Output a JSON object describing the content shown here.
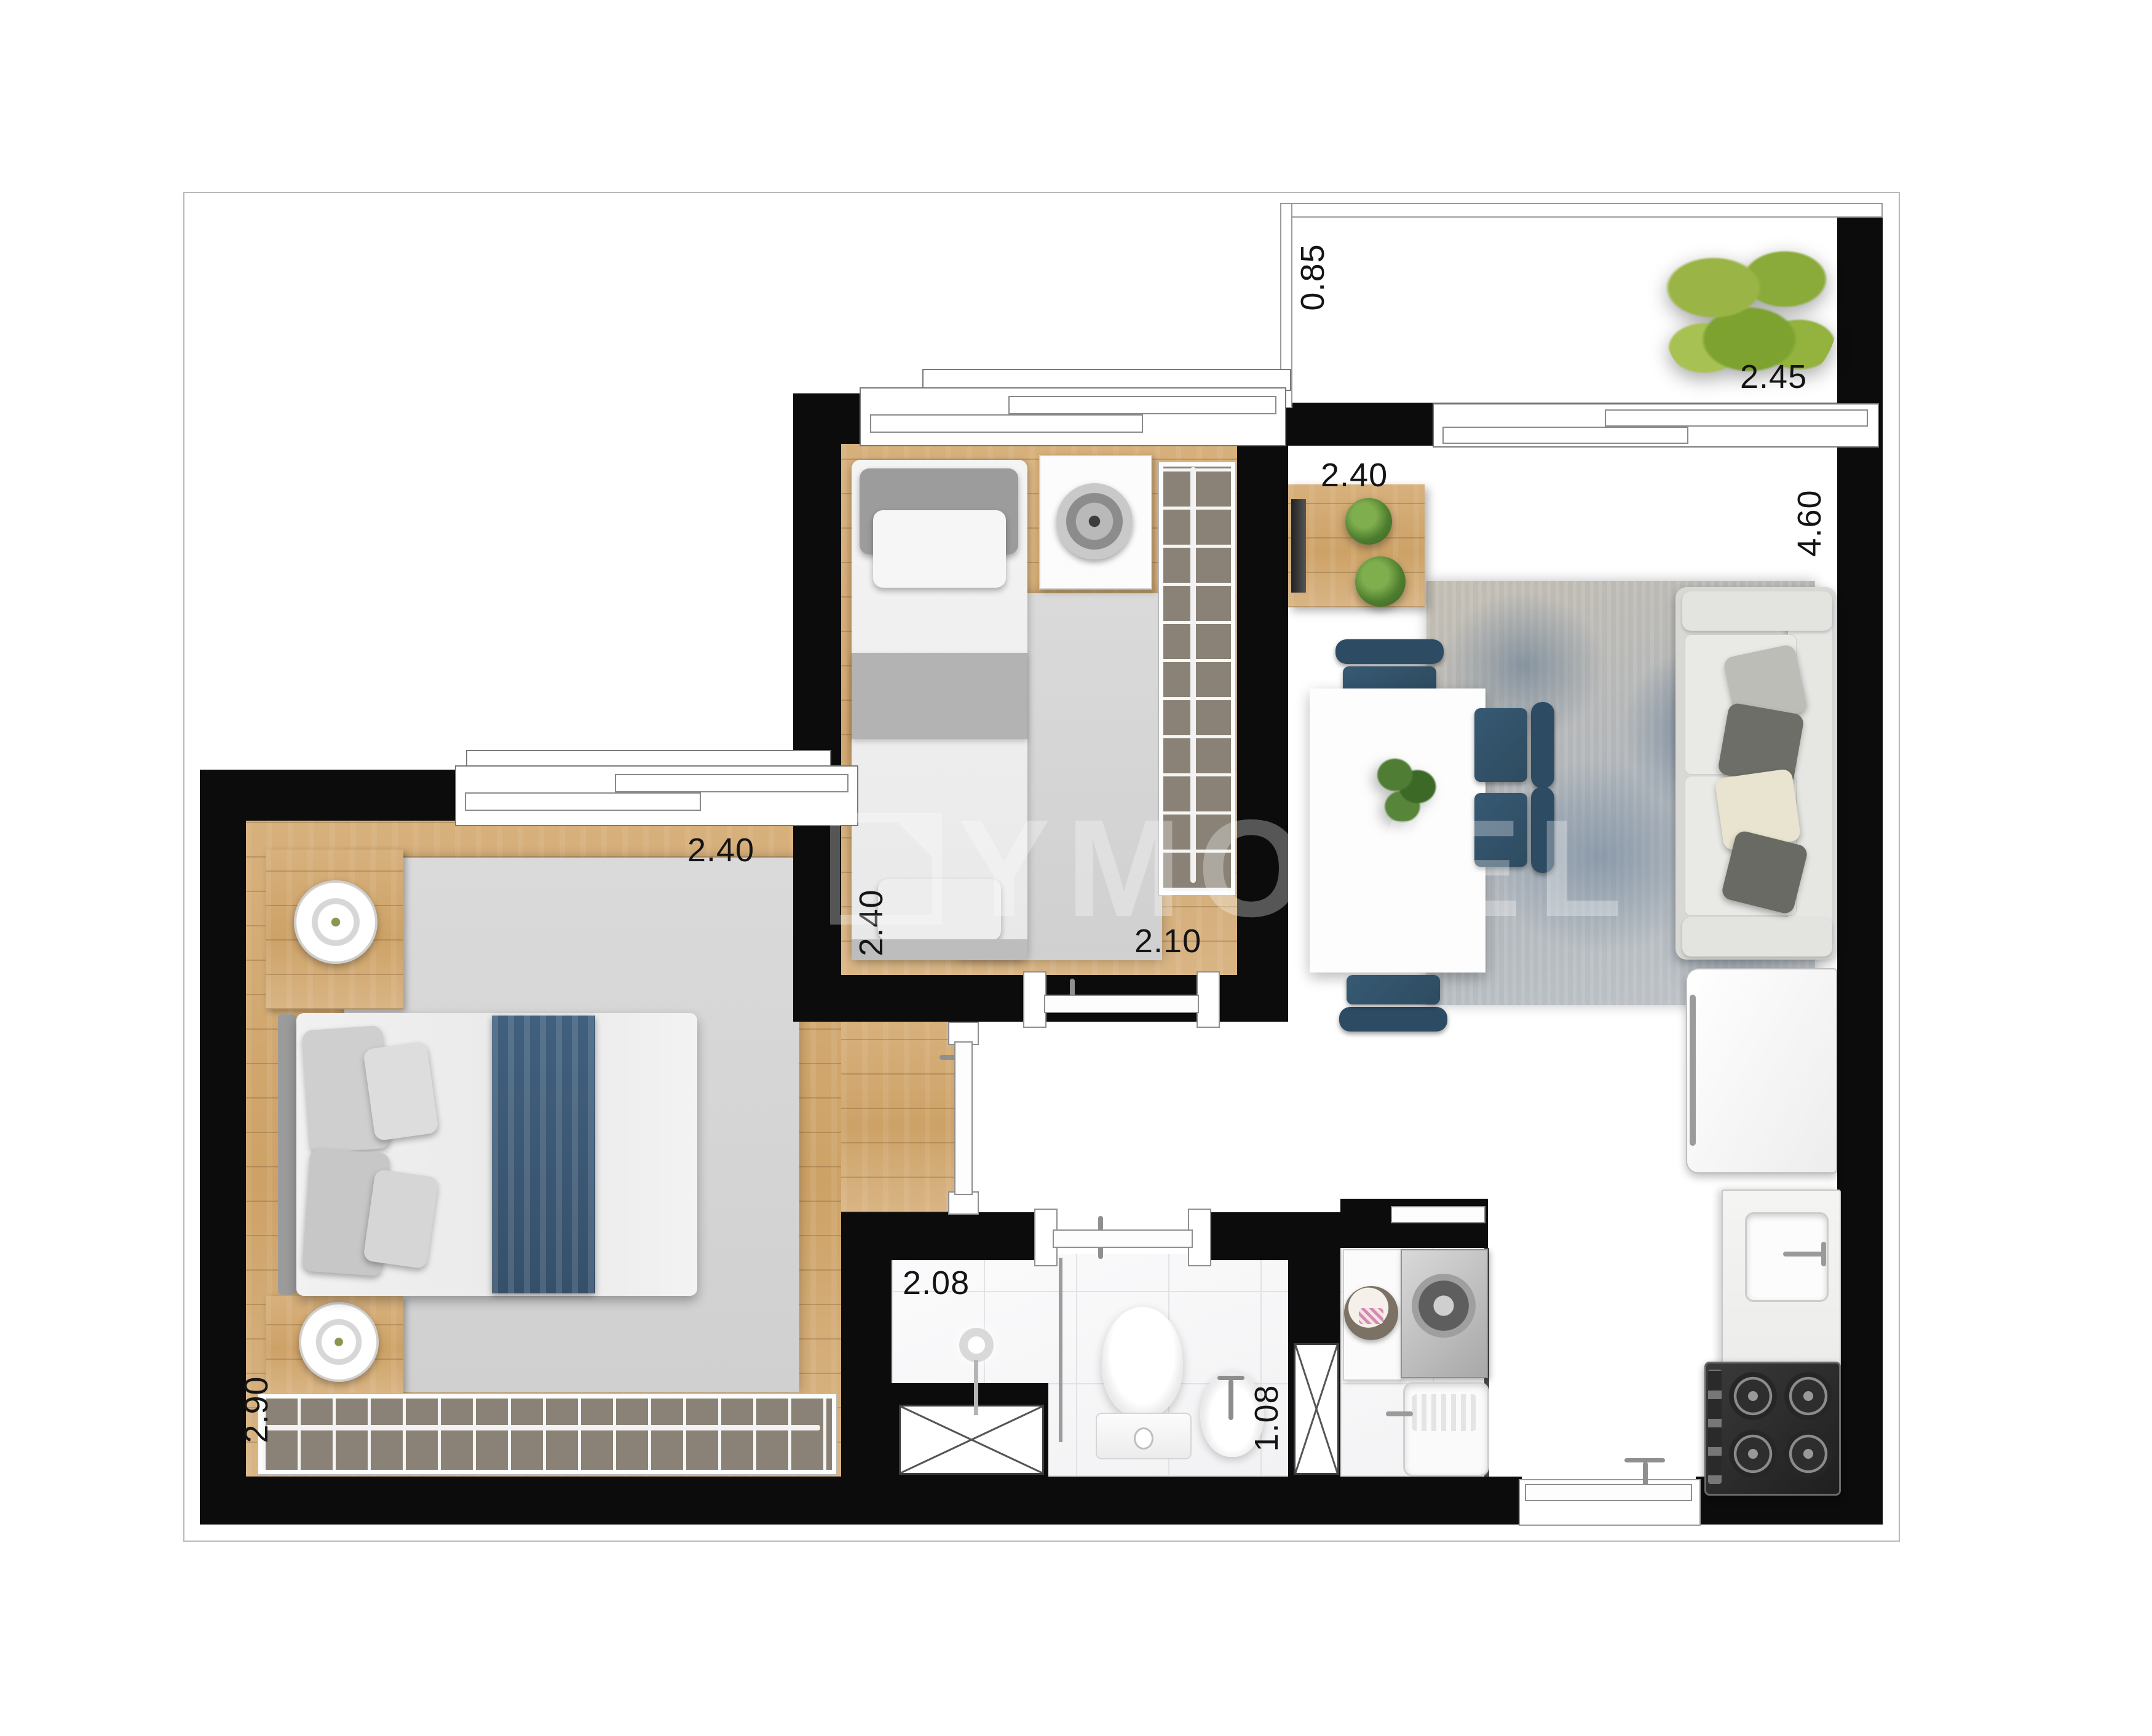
{
  "watermark": {
    "text": "YMOVEL"
  },
  "dimensions": {
    "balcony_depth": "0.85",
    "balcony_width": "2.45",
    "living_width": "2.40",
    "living_length": "4.60",
    "bedroom2_width": "2.40",
    "bedroom2_length": "2.10",
    "master_width": "2.40",
    "master_closet_width": "2.90",
    "bathroom_length": "2.08",
    "bathroom_width": "1.08"
  },
  "colors": {
    "wall": "#0c0c0c",
    "wood_floor": "#d0a870",
    "tile_floor": "#e9e9ee",
    "accent_blue": "#35576f",
    "plant_green": "#4e7d2f"
  }
}
